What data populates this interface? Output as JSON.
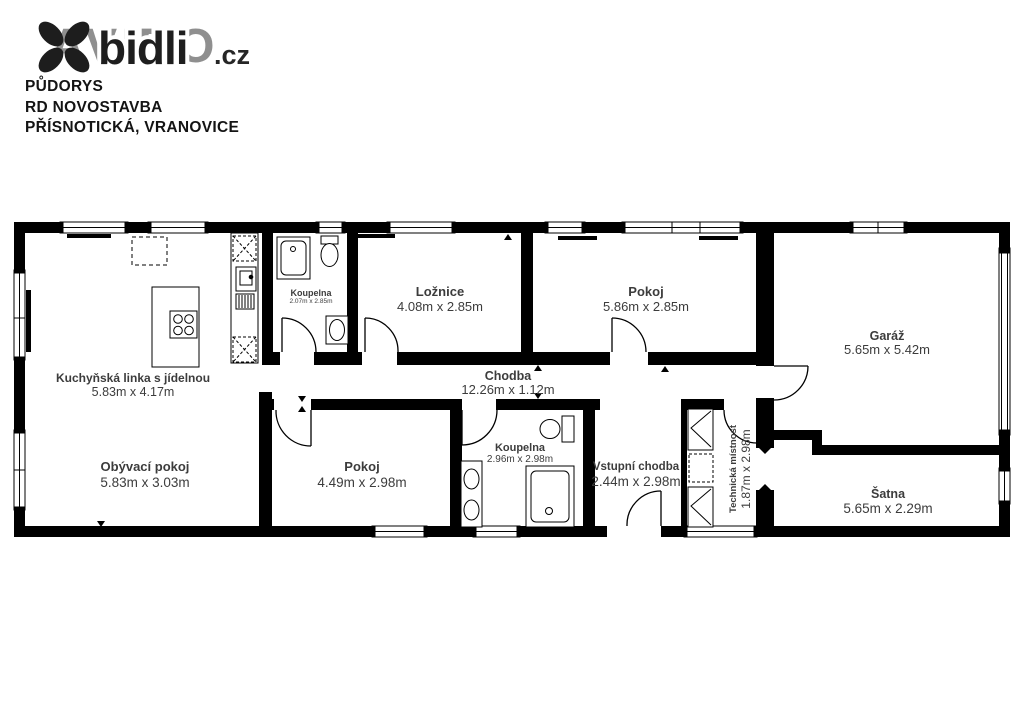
{
  "header": {
    "logo": {
      "ghost": "AVIDO",
      "brand": "bidli",
      "tld": ".cz"
    },
    "title_lines": [
      "PŮDORYS",
      "RD NOVOSTAVBA",
      "PŘÍSNOTICKÁ, VRANOVICE"
    ]
  },
  "floorplan": {
    "colors": {
      "wall": "#000000",
      "background": "#ffffff",
      "label": "#3c3c3c"
    },
    "rooms": [
      {
        "name": "Kuchyňská linka s jídelnou",
        "dims": "5.83m x 4.17m"
      },
      {
        "name": "Koupelna",
        "dims": "2.07m x 2.85m"
      },
      {
        "name": "Ložnice",
        "dims": "4.08m x 2.85m"
      },
      {
        "name": "Pokoj",
        "dims": "5.86m x 2.85m"
      },
      {
        "name": "Garáž",
        "dims": "5.65m x 5.42m"
      },
      {
        "name": "Chodba",
        "dims": "12.26m x 1.12m"
      },
      {
        "name": "Obývací pokoj",
        "dims": "5.83m x 3.03m"
      },
      {
        "name": "Pokoj",
        "dims": "4.49m x 2.98m"
      },
      {
        "name": "Koupelna",
        "dims": "2.96m x 2.98m"
      },
      {
        "name": "Vstupní chodba",
        "dims": "2.44m x 2.98m"
      },
      {
        "name": "Technická místnost",
        "dims": "1.87m x 2.98m"
      },
      {
        "name": "Šatna",
        "dims": "5.65m x 2.29m"
      }
    ]
  }
}
